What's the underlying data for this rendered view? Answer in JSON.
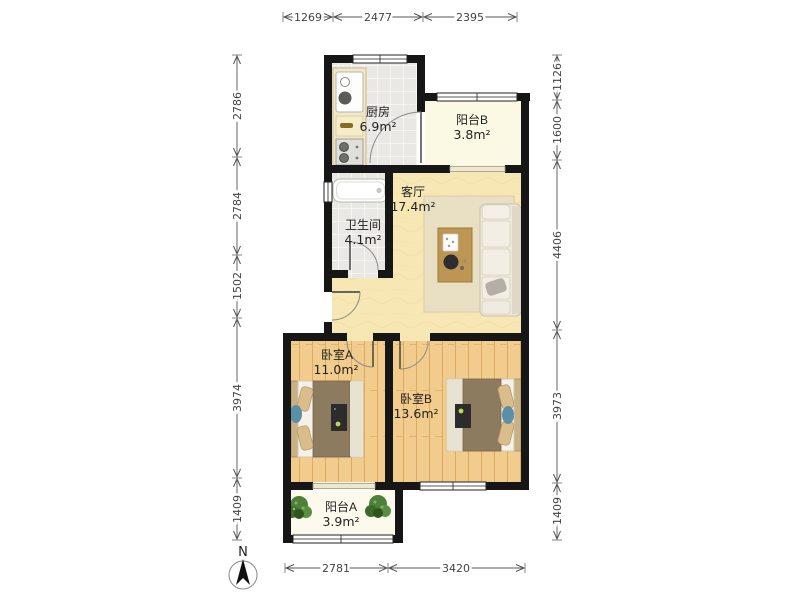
{
  "plan": {
    "rooms": [
      {
        "name": "厨房",
        "area": "6.9m²"
      },
      {
        "name": "阳台B",
        "area": "3.8m²"
      },
      {
        "name": "客厅",
        "area": "17.4m²"
      },
      {
        "name": "卫生间",
        "area": "4.1m²"
      },
      {
        "name": "卧室A",
        "area": "11.0m²"
      },
      {
        "name": "卧室B",
        "area": "13.6m²"
      },
      {
        "name": "阳台A",
        "area": "3.9m²"
      }
    ],
    "dimensions": {
      "top": [
        "1269",
        "2477",
        "2395"
      ],
      "left": [
        "2786",
        "2784",
        "1502",
        "3974",
        "1409"
      ],
      "right": [
        "1126",
        "1600",
        "4406",
        "3973",
        "1409"
      ],
      "bottom": [
        "2781",
        "3420"
      ]
    },
    "compass": {
      "label": "N"
    },
    "colors": {
      "wall": "#161616",
      "tile_floor": "#e9e8e4",
      "living_floor": "#f7e7b4",
      "wood_floor": "#f2cc8d",
      "balcony_floor": "#fbf9e6",
      "bed_duvet": "#8d7b60",
      "sofa": "#eee8db",
      "plant": "#4d8038"
    }
  }
}
